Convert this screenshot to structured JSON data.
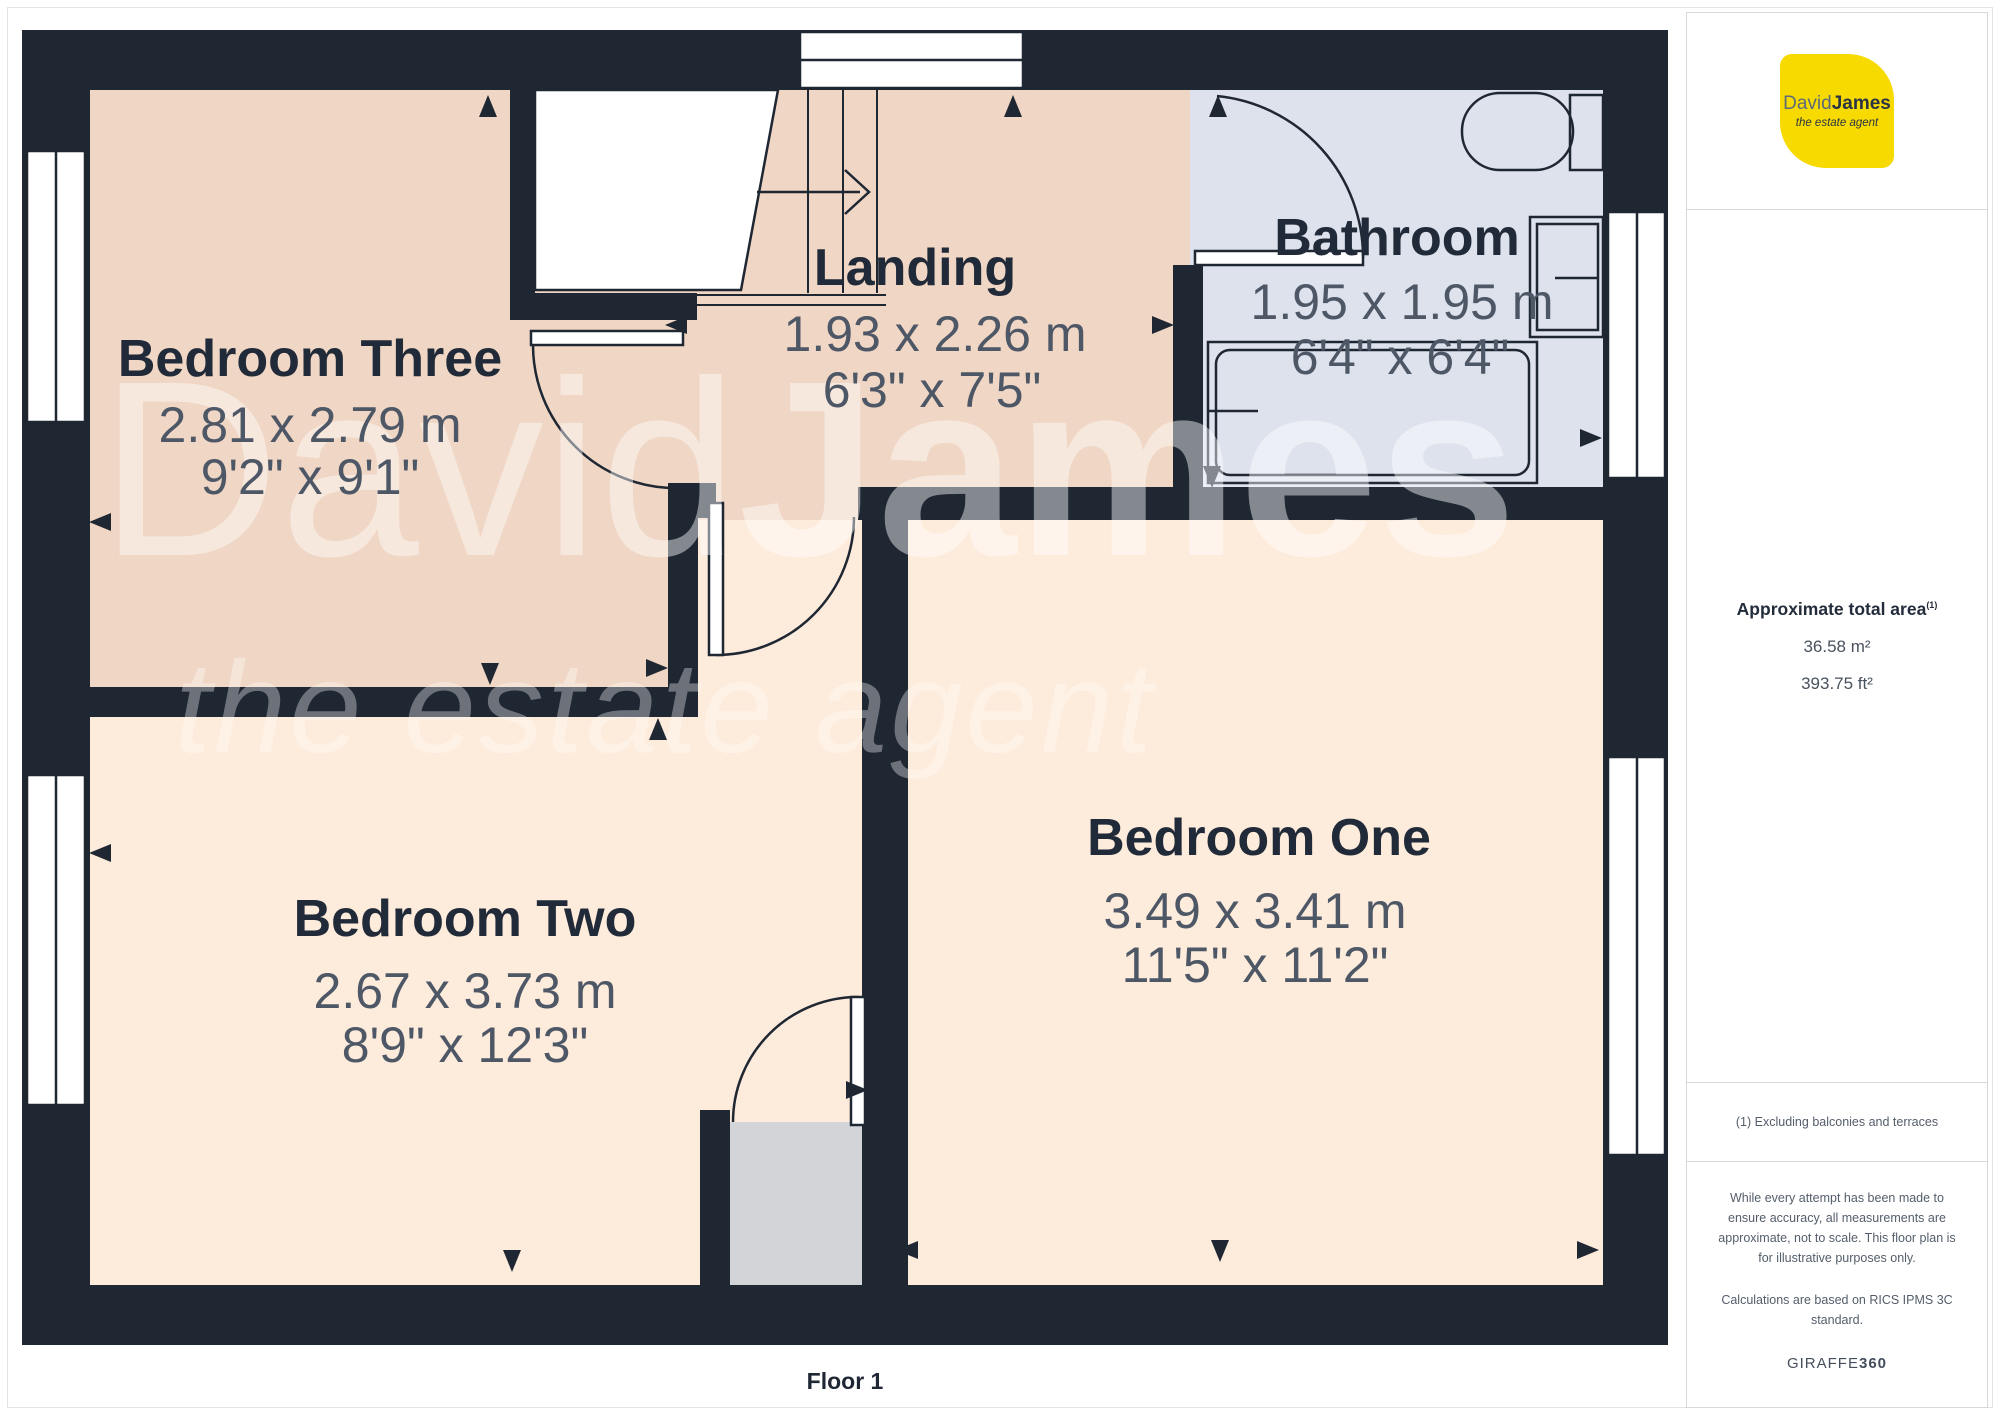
{
  "floor_label": "Floor 1",
  "rooms": [
    {
      "id": "bedroom-three",
      "name": "Bedroom Three",
      "metric": "2.81 x 2.79 m",
      "imperial": "9'2\" x 9'1\""
    },
    {
      "id": "landing",
      "name": "Landing",
      "metric": "1.93 x 2.26 m",
      "imperial": "6'3\" x 7'5\""
    },
    {
      "id": "bathroom",
      "name": "Bathroom",
      "metric": "1.95 x 1.95 m",
      "imperial": "6'4\" x 6'4\""
    },
    {
      "id": "bedroom-two",
      "name": "Bedroom Two",
      "metric": "2.67 x 3.73 m",
      "imperial": "8'9\" x 12'3\""
    },
    {
      "id": "bedroom-one",
      "name": "Bedroom One",
      "metric": "3.49 x 3.41 m",
      "imperial": "11'5\" x 11'2\""
    }
  ],
  "watermark": {
    "brand_light": "David",
    "brand_bold": "James",
    "tagline": "the estate agent"
  },
  "logo": {
    "name_light": "David",
    "name_bold": "James",
    "tagline": "the estate agent"
  },
  "sidebar": {
    "area_title": "Approximate total area",
    "area_superscript": "(1)",
    "area_m2": "36.58 m²",
    "area_ft2": "393.75 ft²",
    "footnote": "(1) Excluding balconies and terraces",
    "disclaimer": "While every attempt has been made to ensure accuracy, all measurements are approximate, not to scale. This floor plan is for illustrative purposes only.",
    "standard": "Calculations are based on RICS IPMS 3C standard.",
    "brand_footer_regular": "GIRAFFE",
    "brand_footer_bold": "360"
  },
  "colors": {
    "wall": "#1f2733",
    "room_warm": "#f0d6c4",
    "room_light": "#fdebdb",
    "bathroom": "#dde2ed",
    "cupboard": "#d2d4d8",
    "label": "#212a38",
    "dimension_text": "#4d5766",
    "logo_yellow": "#F7DA00"
  }
}
